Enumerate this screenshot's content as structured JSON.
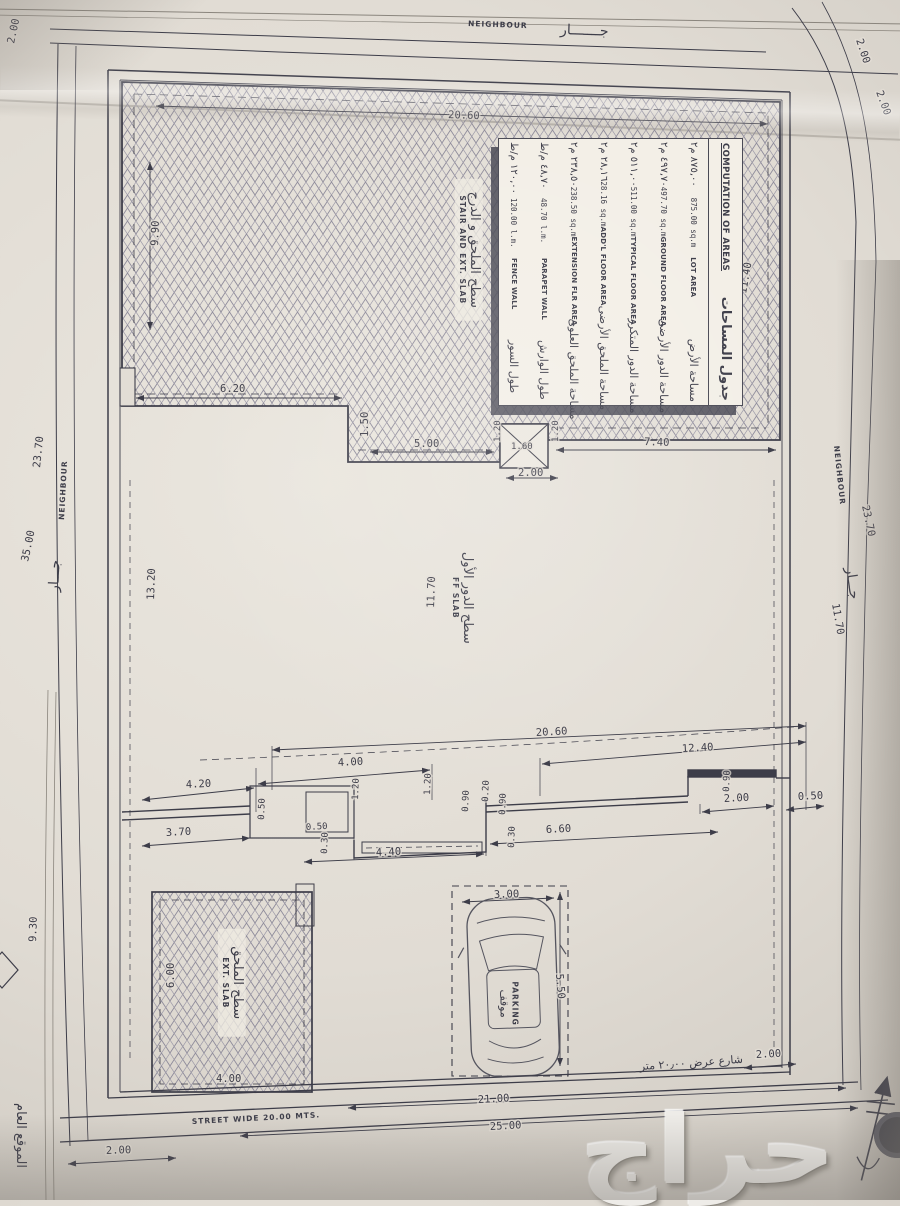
{
  "colors": {
    "paper": "#e2ddd5",
    "ink": "#3d3d49",
    "hatch": "#8f8c9b",
    "table_paper": "#f3efe7",
    "shadow": "#4b4b57",
    "watermark": "#eeece8"
  },
  "boundary": {
    "top": {
      "en": "NEIGHBOUR",
      "ar": "جـــــــار"
    },
    "left": {
      "en": "NEIGHBOUR",
      "ar": "جـــار",
      "d1": "23.70",
      "d2": "35.00"
    },
    "right": {
      "en": "NEIGHBOUR",
      "ar": "جـــار",
      "d1": "23.70",
      "d2": "11.70",
      "s1": "2.00",
      "s2": "2.00"
    },
    "top_left_setback": "2.00"
  },
  "areas_table": {
    "title_en": "COMPUTATION OF AREAS",
    "title_ar": "جدول المساحات",
    "rows": [
      {
        "ar": "مساحة الأرض",
        "en": "LOT AREA",
        "v": "875.00 sq.m",
        "var": "٨٧٥,٠٠ م٢"
      },
      {
        "ar": "مساحة الدور الأرضى",
        "en": "GROUND FLOOR AREA",
        "v": "497.70 sq.m",
        "var": "٤٩٧,٧٠ م٢"
      },
      {
        "ar": "مساحة الدور المتكرر",
        "en": "TYPICAL FLOOR AREA",
        "v": "511.00 sq.m",
        "var": "٥١١,٠٠ م٢"
      },
      {
        "ar": "مساحة الملحق الأرضى",
        "en": "ADD'L FLOOR AREA",
        "v": "28.16 sq.m",
        "var": "٢٨,١٦ م٢"
      },
      {
        "ar": "مساحة الملحق العلوى",
        "en": "EXTENSION FLR AREA",
        "v": "238.50 sq.m",
        "var": "٢٣٨,٥٠ م٢"
      },
      {
        "ar": "طول الوارش",
        "en": "PARAPET WALL",
        "v": "48.70 l.m.",
        "var": "٤٨,٧٠ م/ط"
      },
      {
        "ar": "طول السور",
        "en": "FENCE WALL",
        "v": "120.00 l.m.",
        "var": "١٢٠,٠٠ م/ط"
      }
    ]
  },
  "labels": {
    "stair_ar": "سطح الملحق و الدرج",
    "stair_en": "STAIR AND EXT. SLAB",
    "ff_ar": "سطح الدور الأول",
    "ff_en": "FF SLAB",
    "ext_ar": "سطح الملحق",
    "ext_en": "EXT. SLAB",
    "parking_en": "PARKING",
    "parking_ar": "موقف",
    "site_partial": "الموقع العام"
  },
  "street": {
    "en": "STREET  WIDE  20.00  MTS.",
    "ar": "شارع عرض ٢٠٫٠٠ متر",
    "d21": "21.00",
    "d25": "25.00",
    "d2r": "2.00",
    "d2l": "2.00"
  },
  "roof": {
    "w": "20.60",
    "right": "11.40",
    "left": "9.90",
    "steps": [
      "6.20",
      "1.50",
      "5.00",
      "1.20",
      "1.60",
      "1.20",
      "7.40",
      "2.00"
    ]
  },
  "mid": {
    "left": "13.20",
    "center": "11.70"
  },
  "band": [
    "20.60",
    "12.40",
    "4.00",
    "4.20",
    "2.00",
    "0.50",
    "3.70",
    "0.50",
    "0.50",
    "1.20",
    "0.30",
    "4.40",
    "1.20",
    "0.90",
    "0.20",
    "0.90",
    "0.30",
    "6.60",
    "0.90"
  ],
  "ext_slab": {
    "d930": "9.30",
    "d600": "6.00",
    "d400": "4.00"
  },
  "parking": {
    "w": "3.00",
    "l": "5.50"
  },
  "watermark": "حراج"
}
